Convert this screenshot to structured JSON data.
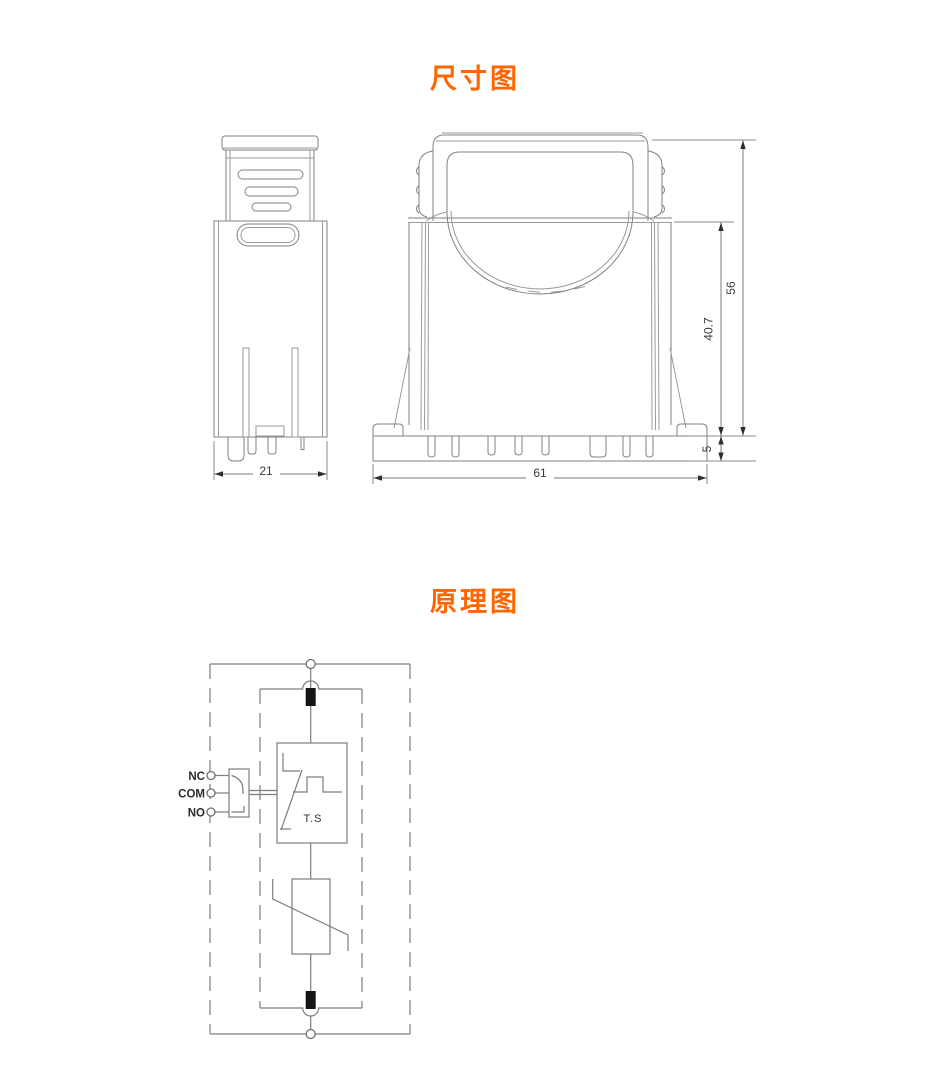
{
  "dimension_diagram": {
    "title": "尺寸图",
    "side_view": {
      "width": "21"
    },
    "front_view": {
      "width": "61",
      "total_height": "56",
      "body_height": "40.7",
      "base_height": "5"
    }
  },
  "schematic": {
    "title": "原理图",
    "terminals": {
      "nc": "NC",
      "com": "COM",
      "no": "NO"
    },
    "labels": {
      "thermal_switch": "T.S"
    }
  },
  "colors": {
    "accent": "#ff6600",
    "drawing_line": "#828282",
    "schematic_line": "#7d7d7d",
    "text": "#3a3a3a",
    "blade_black": "#151515",
    "background": "#ffffff"
  }
}
